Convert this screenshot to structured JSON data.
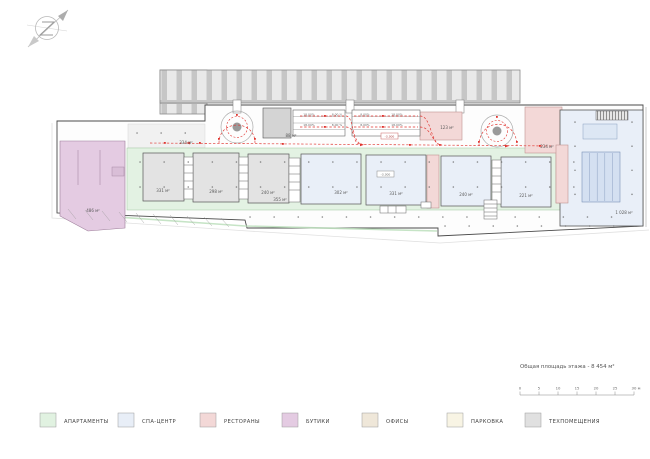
{
  "plan": {
    "area_labels": {
      "boutique_left": "486 м²",
      "tech_strip": "334 м²",
      "apartment_1": "331 м²",
      "apartment_2": "298 м²",
      "apartment_3": "240 м²",
      "corridor": "355 м²",
      "spa_1": "302 м²",
      "spa_2": "331 м²",
      "spa_3": "240 м²",
      "spa_4": "221 м²",
      "restaurant_top": "123 м²",
      "restaurant_right": "234 м²",
      "ramp_zone": "88 м²",
      "spa_pool_hall": "1 028 м²"
    },
    "elevation_markers": [
      "-3.300",
      "-3.300"
    ],
    "ramp_slopes": {
      "left_block": {
        "row1": [
          "18,00%",
          "8,00 %"
        ],
        "row2": [
          "18,00%",
          "8,00 %"
        ]
      },
      "right_block": {
        "row1": [
          "8,00%",
          "18,00%"
        ],
        "row2": [
          "8,00%",
          "18,00%"
        ]
      }
    }
  },
  "summary": {
    "total_area_label": "Общая площадь этажа - 8 454 м²"
  },
  "scale_bar": {
    "ticks": [
      "0",
      "5",
      "10",
      "15",
      "20",
      "25",
      "30 м"
    ]
  },
  "legend": {
    "items": [
      {
        "name": "apartments",
        "label": "АПАРТАМЕНТЫ",
        "color": "#e1f2e1"
      },
      {
        "name": "spa-center",
        "label": "СПА-ЦЕНТР",
        "color": "#e8eef7"
      },
      {
        "name": "restaurants",
        "label": "РЕСТОРАНЫ",
        "color": "#f3d8d7"
      },
      {
        "name": "boutiques",
        "label": "БУТИКИ",
        "color": "#e4cbe2"
      },
      {
        "name": "offices",
        "label": "ОФИСЫ",
        "color": "#efe7d9"
      },
      {
        "name": "parking",
        "label": "ПАРКОВКА",
        "color": "#f8f4e4"
      },
      {
        "name": "tech-rooms",
        "label": "ТЕХПОМЕЩЕНИЯ",
        "color": "#e0e0e0"
      }
    ]
  }
}
